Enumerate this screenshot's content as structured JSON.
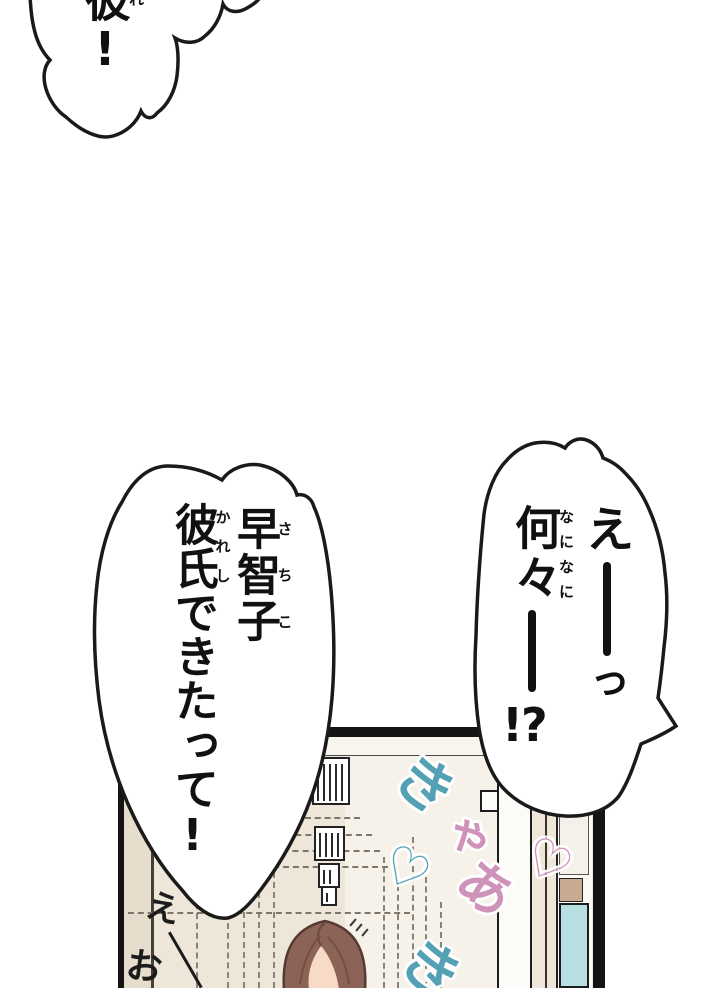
{
  "bubbles": {
    "top_left": {
      "base": "彼",
      "ruby": "れ",
      "tail": "!"
    },
    "left": {
      "name": "早智子",
      "name_ruby": "さちこ",
      "phrase": "彼氏",
      "phrase_ruby": "かれし",
      "phrase_rest": "できたって!"
    },
    "right": {
      "exclaim_open": "え",
      "small_tsu": "っ",
      "dash": "ー",
      "what": "何々",
      "what_ruby": "なになに",
      "bang": "!?"
    }
  },
  "panel": {
    "sfx": {
      "ki1": "き",
      "ya": "ゃ",
      "a": "あ",
      "heart_left": "♡",
      "heart_right": "♡",
      "ki2": "き"
    },
    "handwriting": {
      "e": "え",
      "o": "お"
    },
    "colors": {
      "sfx_teal": "#54a1b5",
      "sfx_pink": "#cf93ba",
      "wall": "#eee7d9",
      "wall_far": "#f6f2ea",
      "hair": "#8b6357",
      "skin": "#f8dbc7",
      "glass": "#b7dee1",
      "wood": "#c9a98f"
    }
  }
}
